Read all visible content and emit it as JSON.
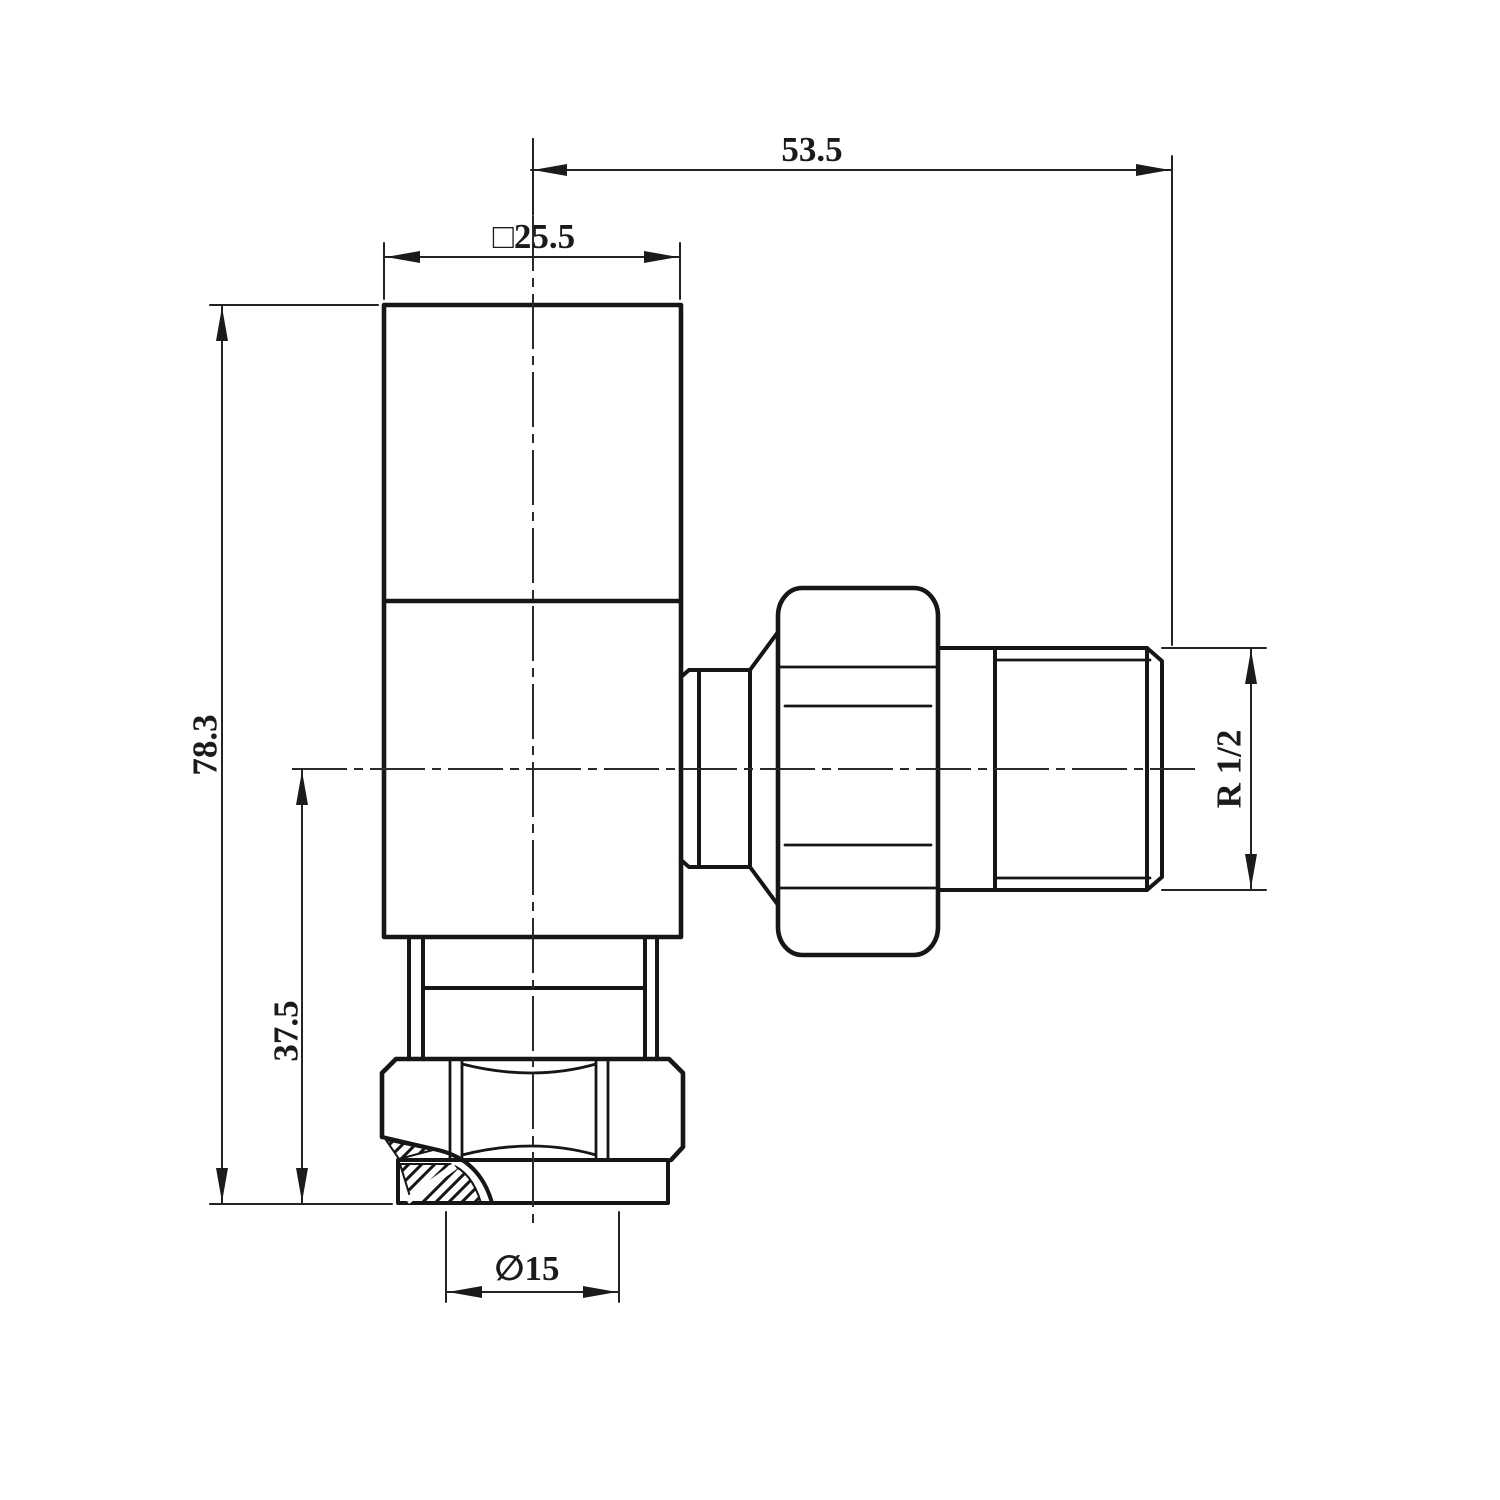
{
  "dimensions": {
    "top_width": "53.5",
    "head_width": "□25.5",
    "overall_height": "78.3",
    "lower_height": "37.5",
    "outlet_thread": "R 1/2",
    "inlet_diameter": "∅15"
  }
}
